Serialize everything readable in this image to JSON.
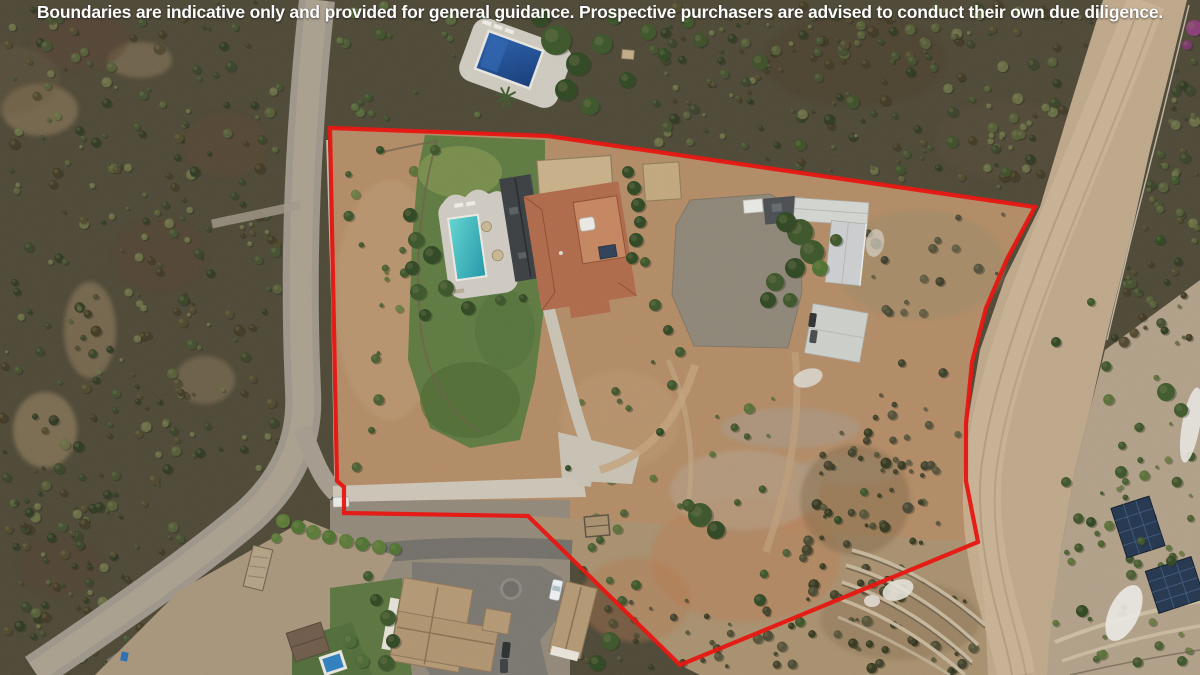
{
  "disclaimer": "Boundaries are indicative only and provided for general guidance. Prospective purchasers are advised to conduct their own due diligence.",
  "overlay": {
    "boundary_color": "#e8120d",
    "boundary_stroke_width": 4.2,
    "boundary_points": [
      [
        330,
        128
      ],
      [
        548,
        136
      ],
      [
        1035,
        207
      ],
      [
        1007,
        259
      ],
      [
        986,
        308
      ],
      [
        972,
        362
      ],
      [
        966,
        424
      ],
      [
        966,
        481
      ],
      [
        978,
        542
      ],
      [
        680,
        665
      ],
      [
        528,
        516
      ],
      [
        344,
        513
      ],
      [
        344,
        487
      ],
      [
        337,
        481
      ]
    ]
  },
  "scene": {
    "description": "Aerial drone photograph of a rural hillside property outlined in red",
    "features": [
      "scrubland",
      "dirt-road-left",
      "dirt-road-right",
      "asphalt-road",
      "main-villa",
      "terracotta-roof",
      "dark-slate-roof-wing",
      "swimming-pool",
      "pool-terrace",
      "lawn",
      "sand-arena",
      "stable-outbuildings",
      "gravel-courtyard",
      "upper-neighbour-pool",
      "palm-tree",
      "terraced-retaining-walls",
      "solar-panel-arrays",
      "entrance-gate",
      "gate-pillar",
      "hedge-row",
      "lower-neighbour-villa",
      "parking-court",
      "parked-cars",
      "small-stone-shed"
    ]
  }
}
